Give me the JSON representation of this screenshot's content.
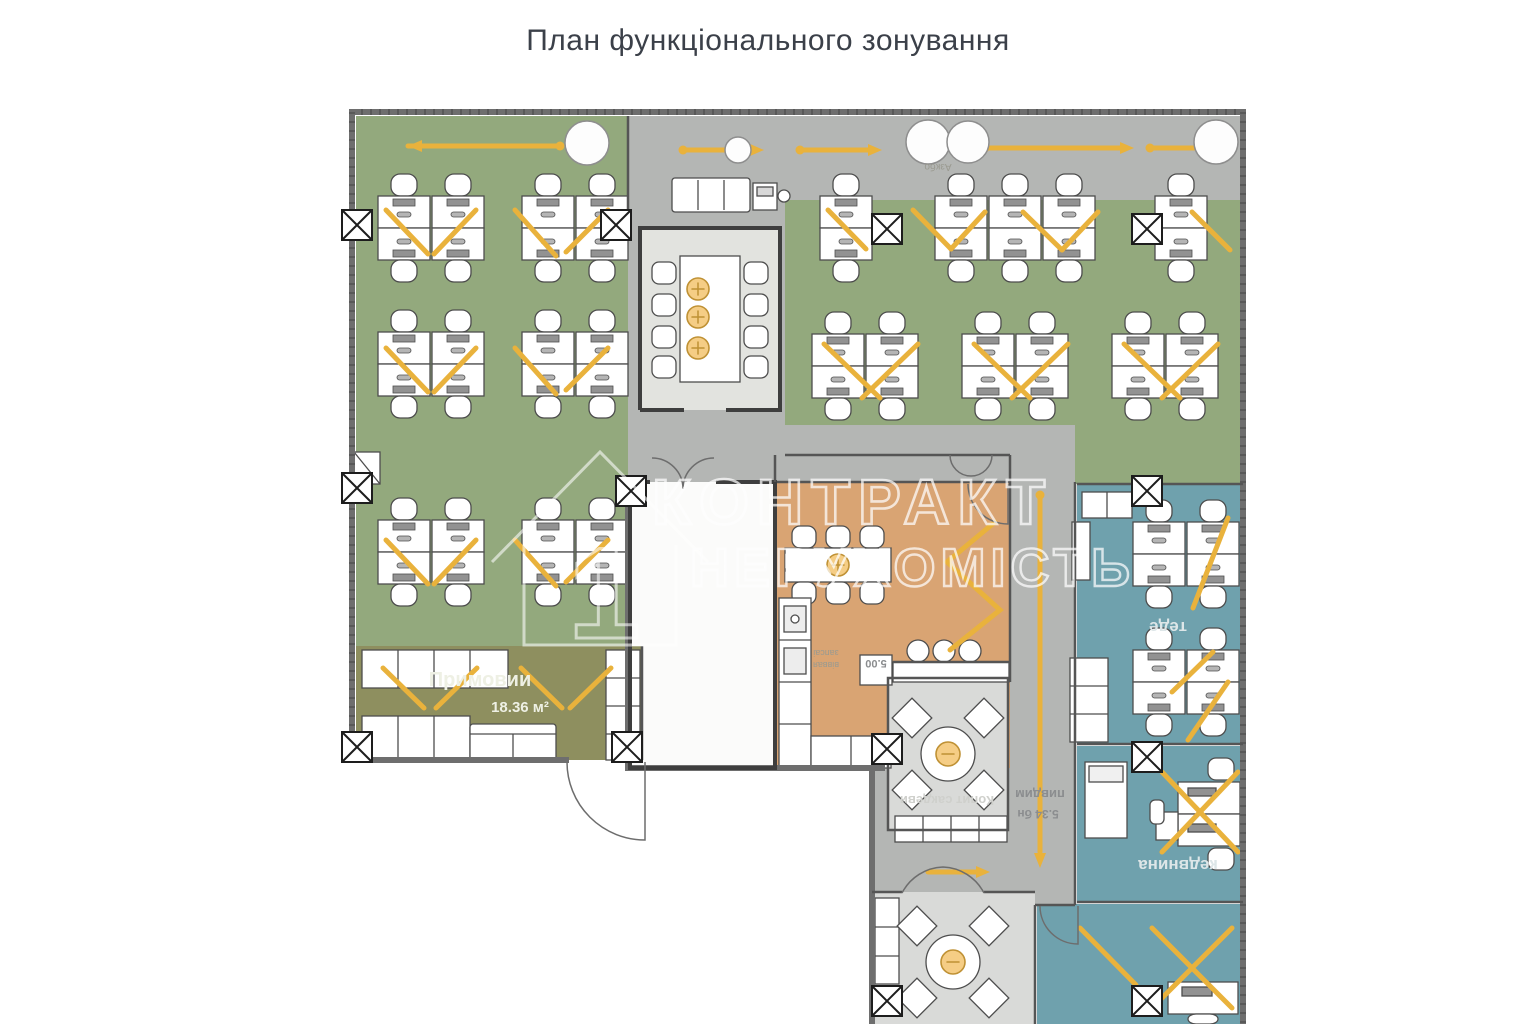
{
  "title": "План функціонального зонування",
  "watermark": {
    "line1": "КОНТРАКТ",
    "line2": "НЕРУХОМІСТЬ",
    "logo_number": "1"
  },
  "rooms": {
    "reception": {
      "name": "Примовии",
      "area": "18.36 м²"
    },
    "office_blue_top": {
      "name": "теде"
    },
    "office_blue_mid": {
      "name": "кедвнина"
    },
    "meeting_small": {
      "name": "Копит сакдеви"
    },
    "shaft": {
      "name": "пивдим",
      "area": "5.34 бн"
    },
    "kitchen": {
      "note_line1": "запсаі",
      "note_line2": "віввая",
      "dimension": "5.00"
    },
    "corridor": {
      "column_note": "Азкбо"
    }
  },
  "colors": {
    "green": "#93a97d",
    "gray": "#b4b6b4",
    "olive": "#8e8f5f",
    "orange": "#d9a473",
    "blue": "#6fa1ad",
    "floor_light": "#e2e3df",
    "floor_room": "#d9dad8",
    "white_room": "#fbfbfa",
    "yellow": "#e9b23c",
    "wall": "#6e6e6e",
    "accent_power": "#f5cd85"
  }
}
